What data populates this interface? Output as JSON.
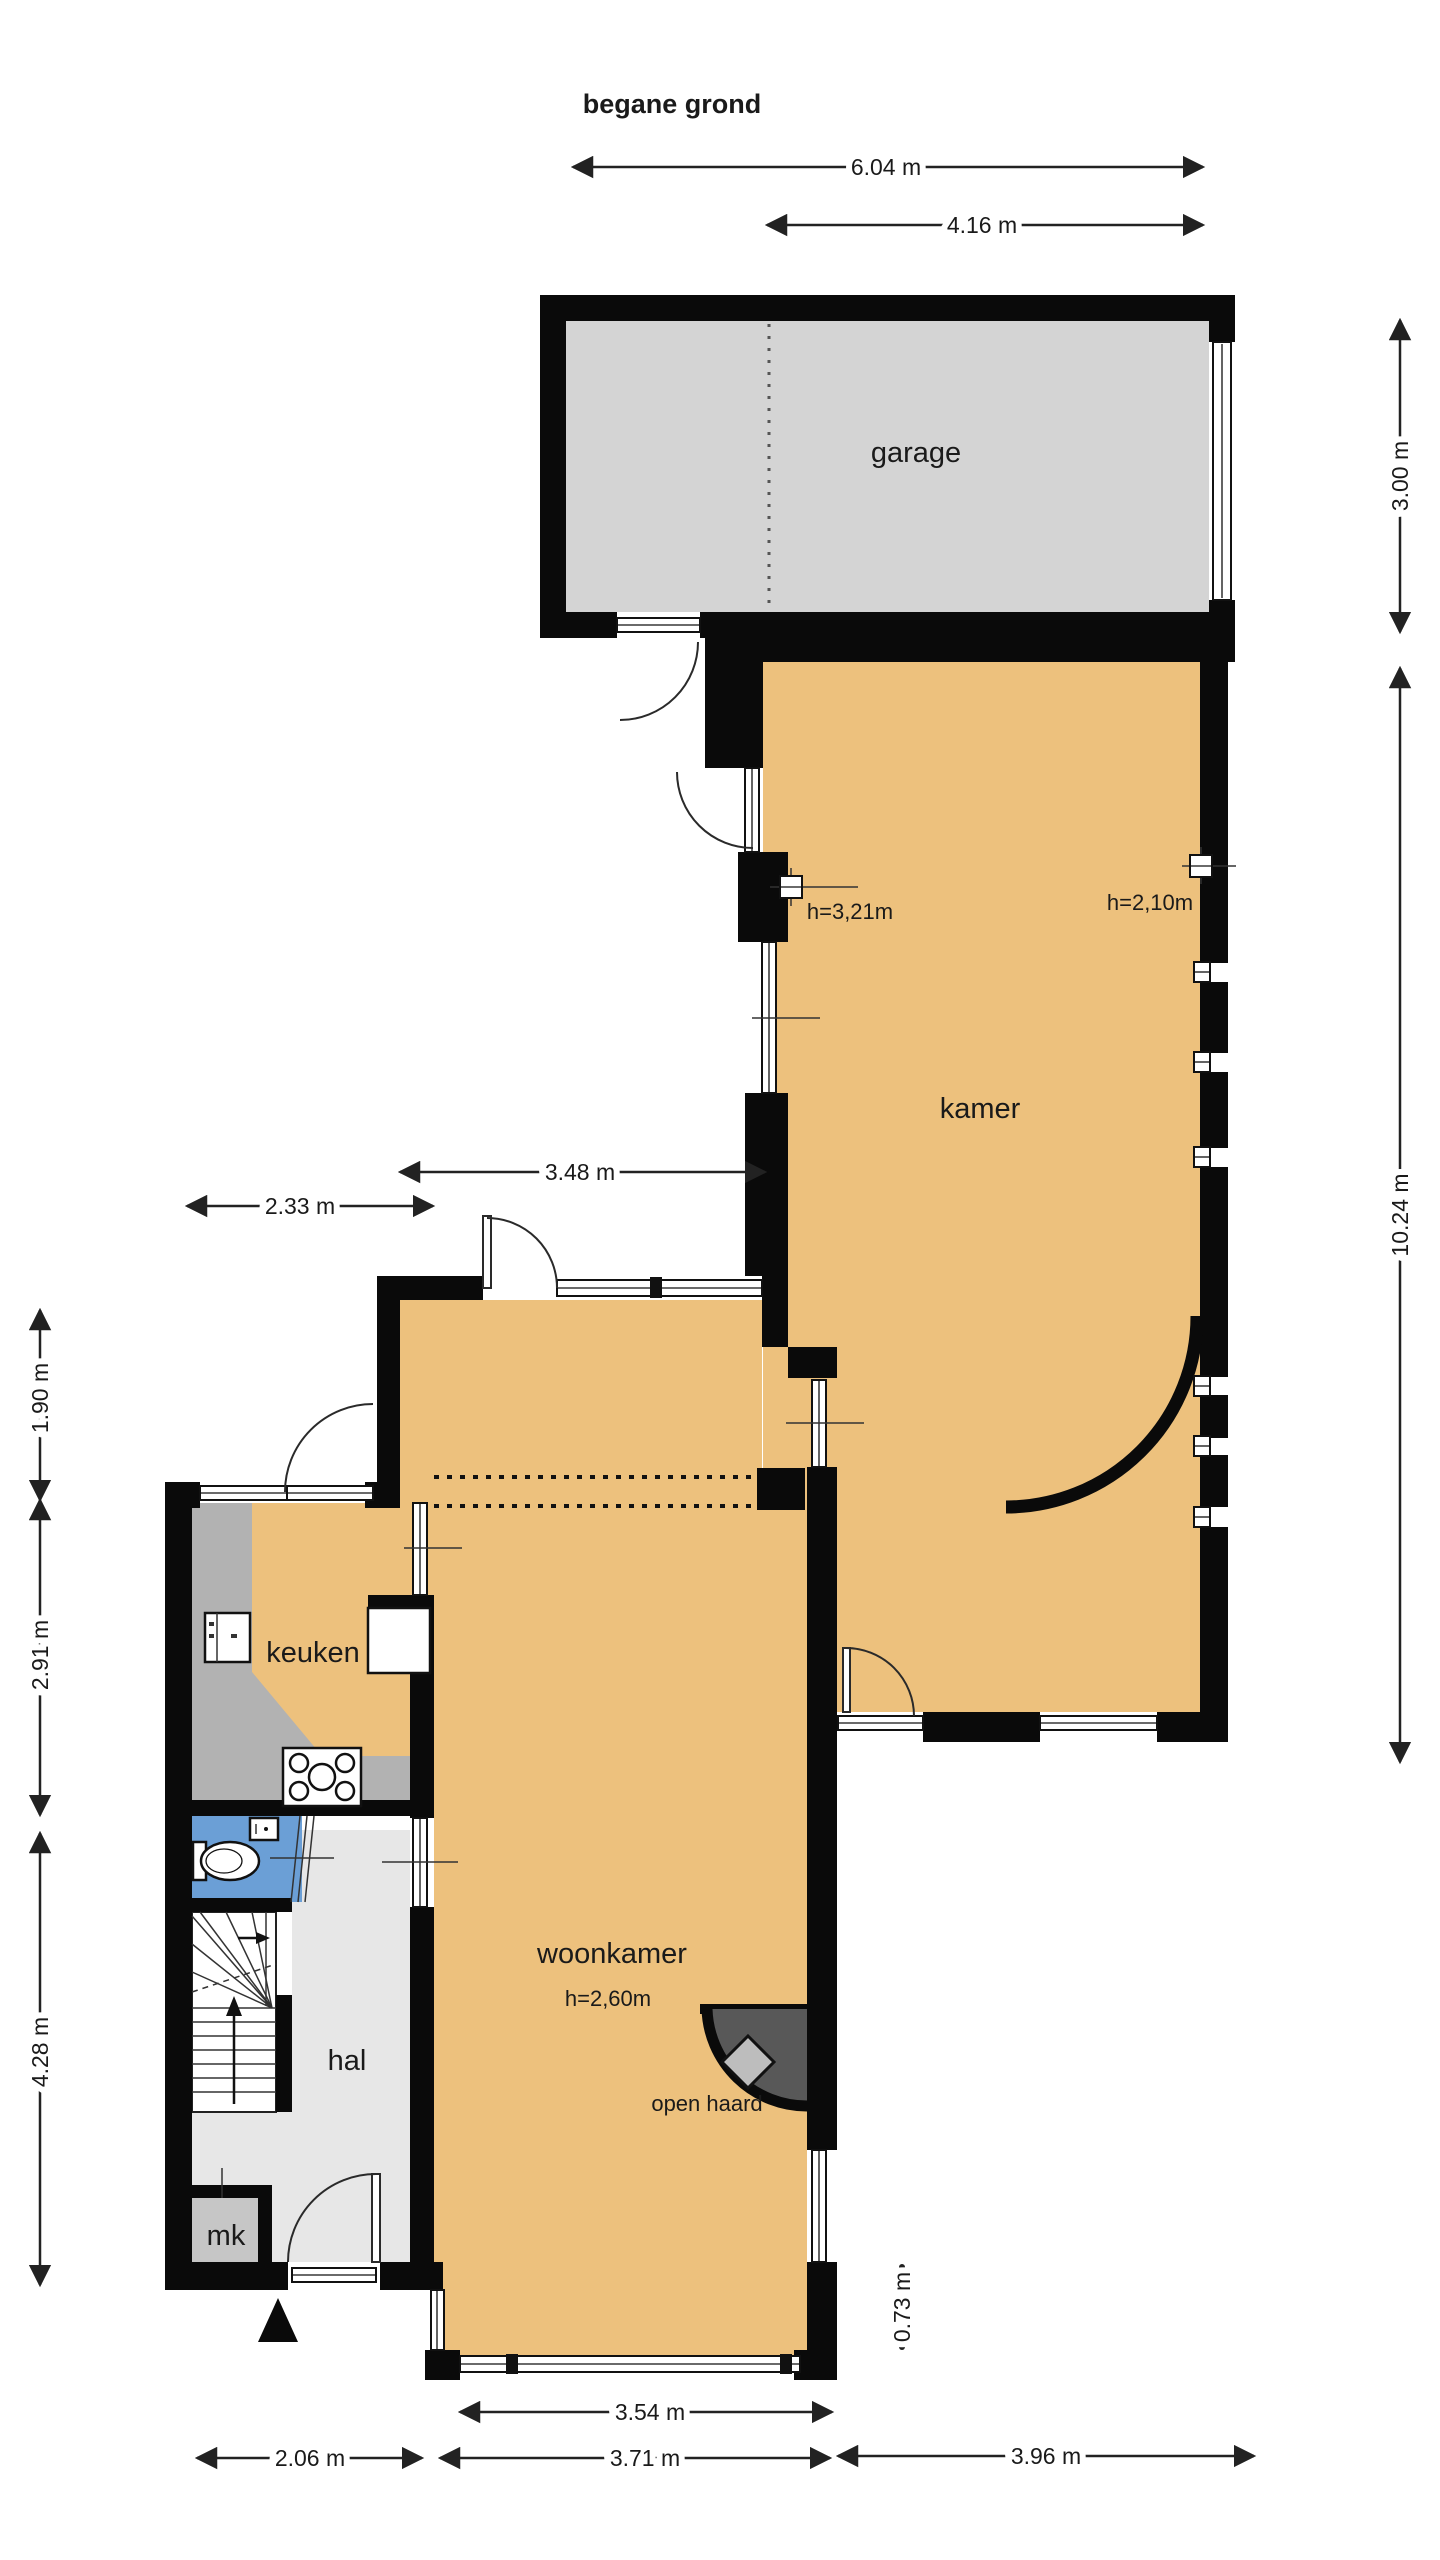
{
  "title": "begane grond",
  "labels": {
    "garage": "garage",
    "kamer": "kamer",
    "keuken": "keuken",
    "woonkamer": "woonkamer",
    "hal": "hal",
    "mk": "mk",
    "open_haard": "open haard"
  },
  "heights": {
    "woonkamer": "h=2,60m",
    "kamer_left": "h=3,21m",
    "kamer_right": "h=2,10m"
  },
  "dimensions": {
    "top_outer": "6.04 m",
    "top_inner": "4.16 m",
    "right_garage": "3.00 m",
    "right_kamer": "10.24 m",
    "mid_kamer_width": "3.48 m",
    "mid_keuken_width": "2.33 m",
    "left_upper": "1.90 m",
    "left_middle": "2.91 m",
    "left_lower": "4.28 m",
    "bottom_window": "3.54 m",
    "bottom_hal": "2.06 m",
    "bottom_woonkamer": "3.71 m",
    "bottom_kamer": "3.96 m",
    "right_offset": "0.73 m"
  },
  "colors": {
    "room_fill": "#edc17d",
    "garage_fill": "#d4d4d4",
    "hal_fill": "#e7e7e7",
    "counter_fill": "#b2b2b2",
    "toilet_fill": "#6b9fd6",
    "mk_fill": "#c6c6c6",
    "fireplace_fill": "#585858",
    "fireplace_diamond": "#bdbdbd",
    "wall_color": "#0a0a0a",
    "stairs_fill": "#ffffff"
  }
}
